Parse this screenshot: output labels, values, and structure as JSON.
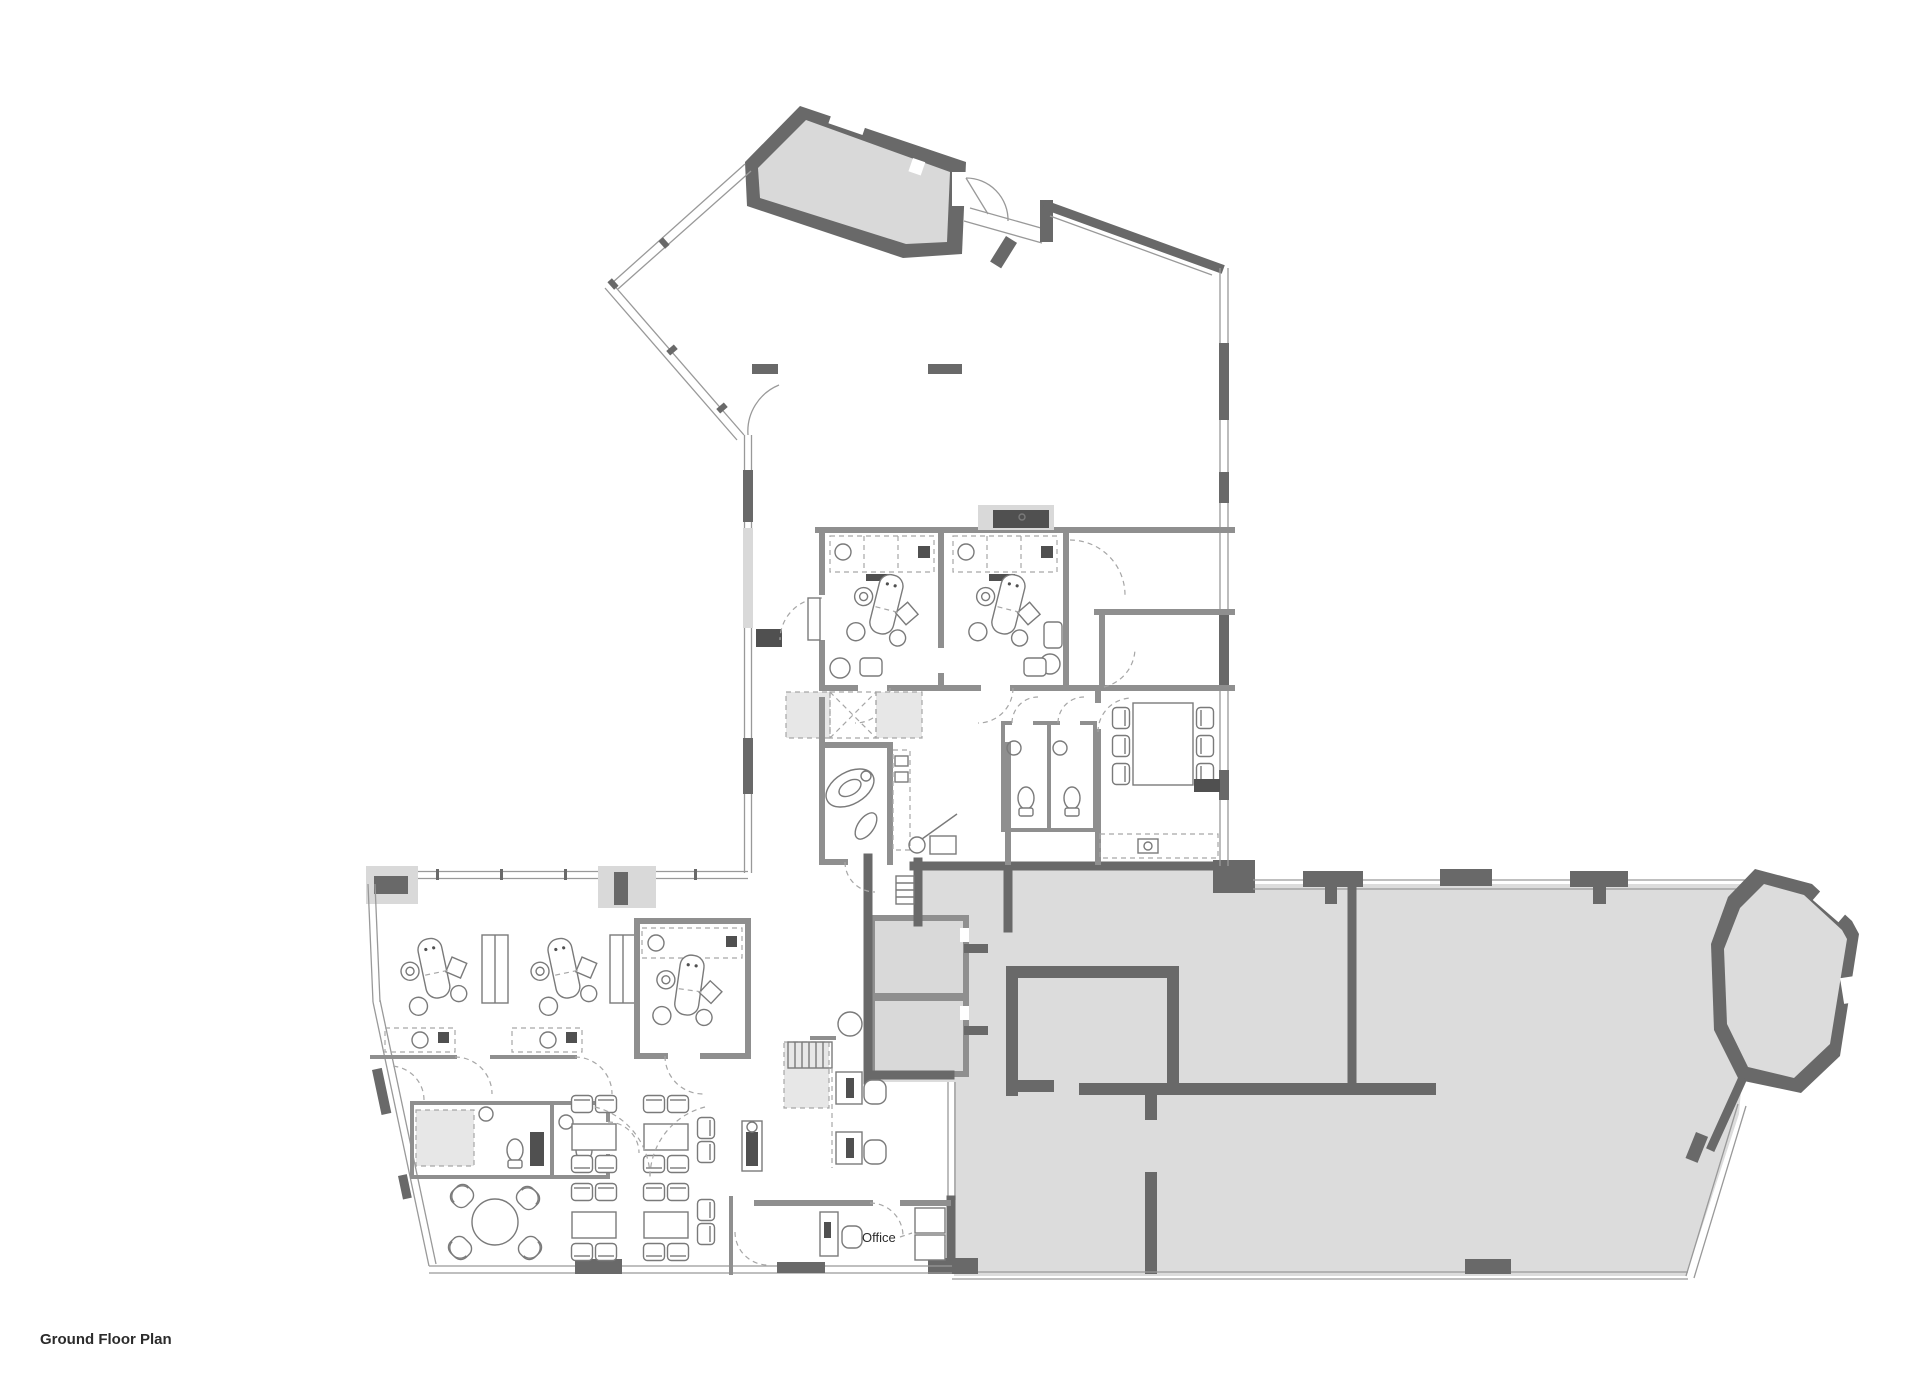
{
  "page": {
    "background": "#ffffff"
  },
  "labels": {
    "office": "Office",
    "title": "Ground Floor Plan"
  },
  "colors": {
    "bg": "#ffffff",
    "wall-dark": "#696969",
    "wall-mid": "#8f8f8f",
    "line": "#999999",
    "fill-room": "#d9d9d9",
    "fill-shell": "#dcdcdc",
    "fill-light": "#e7e7e7",
    "furn": "#7a7a7a",
    "furn-dark": "#505050",
    "dash": "#a6a6a6",
    "text": "#2b2b2b"
  }
}
